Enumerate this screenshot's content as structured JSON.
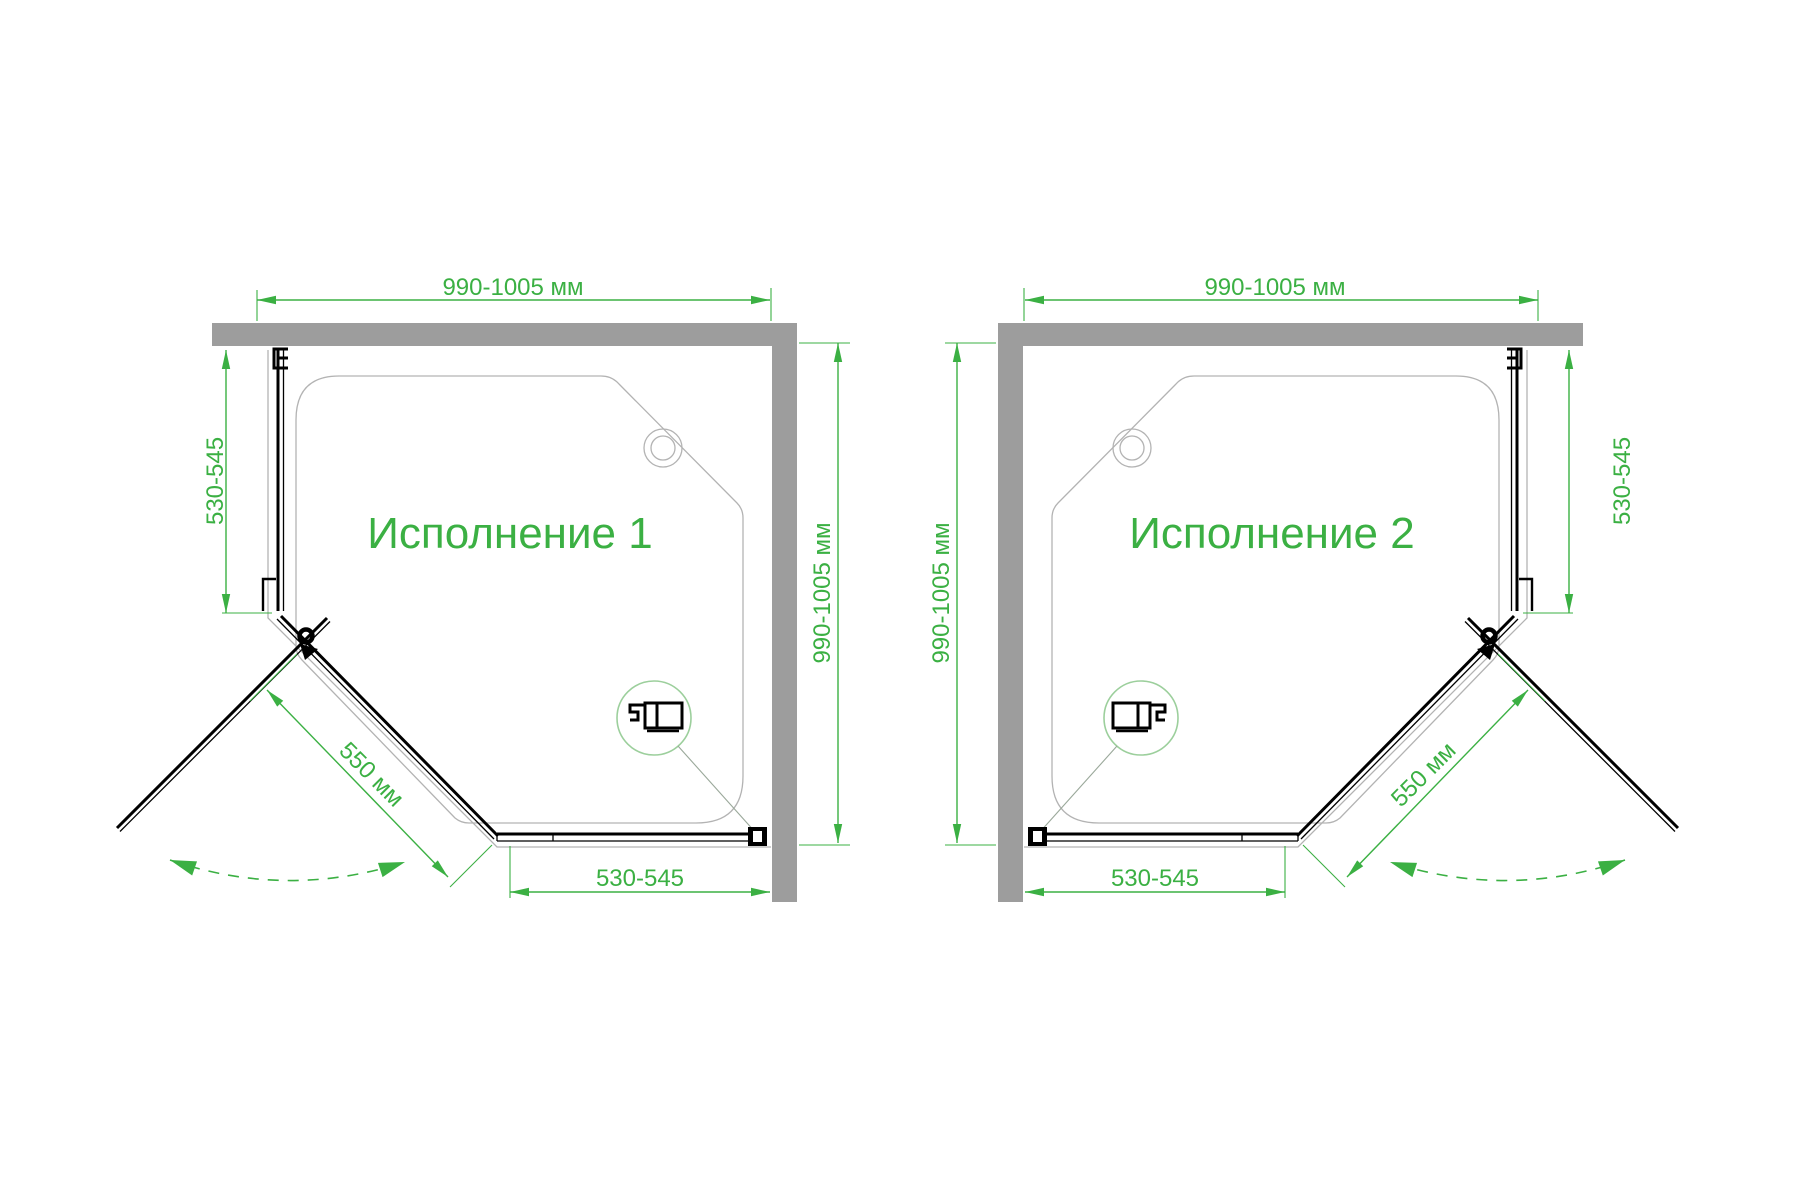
{
  "colors": {
    "green": "#3bb043",
    "detail_ring_green": "#9ccf9c",
    "leader": "#9aa89a",
    "wall_gray": "#9d9d9d",
    "tray_gray": "#b3b3b3",
    "ink": "#000000",
    "background": "#ffffff"
  },
  "diagrams": [
    {
      "title": "Исполнение 1",
      "dim_top_width": "990-1005 мм",
      "dim_side_panel": "530-545",
      "dim_depth": "990-1005 мм",
      "dim_bottom_panel": "530-545",
      "dim_door_width": "550 мм"
    },
    {
      "title": "Исполнение 2",
      "dim_top_width": "990-1005 мм",
      "dim_side_panel": "530-545",
      "dim_depth": "990-1005 мм",
      "dim_bottom_panel": "530-545",
      "dim_door_width": "550 мм"
    }
  ]
}
